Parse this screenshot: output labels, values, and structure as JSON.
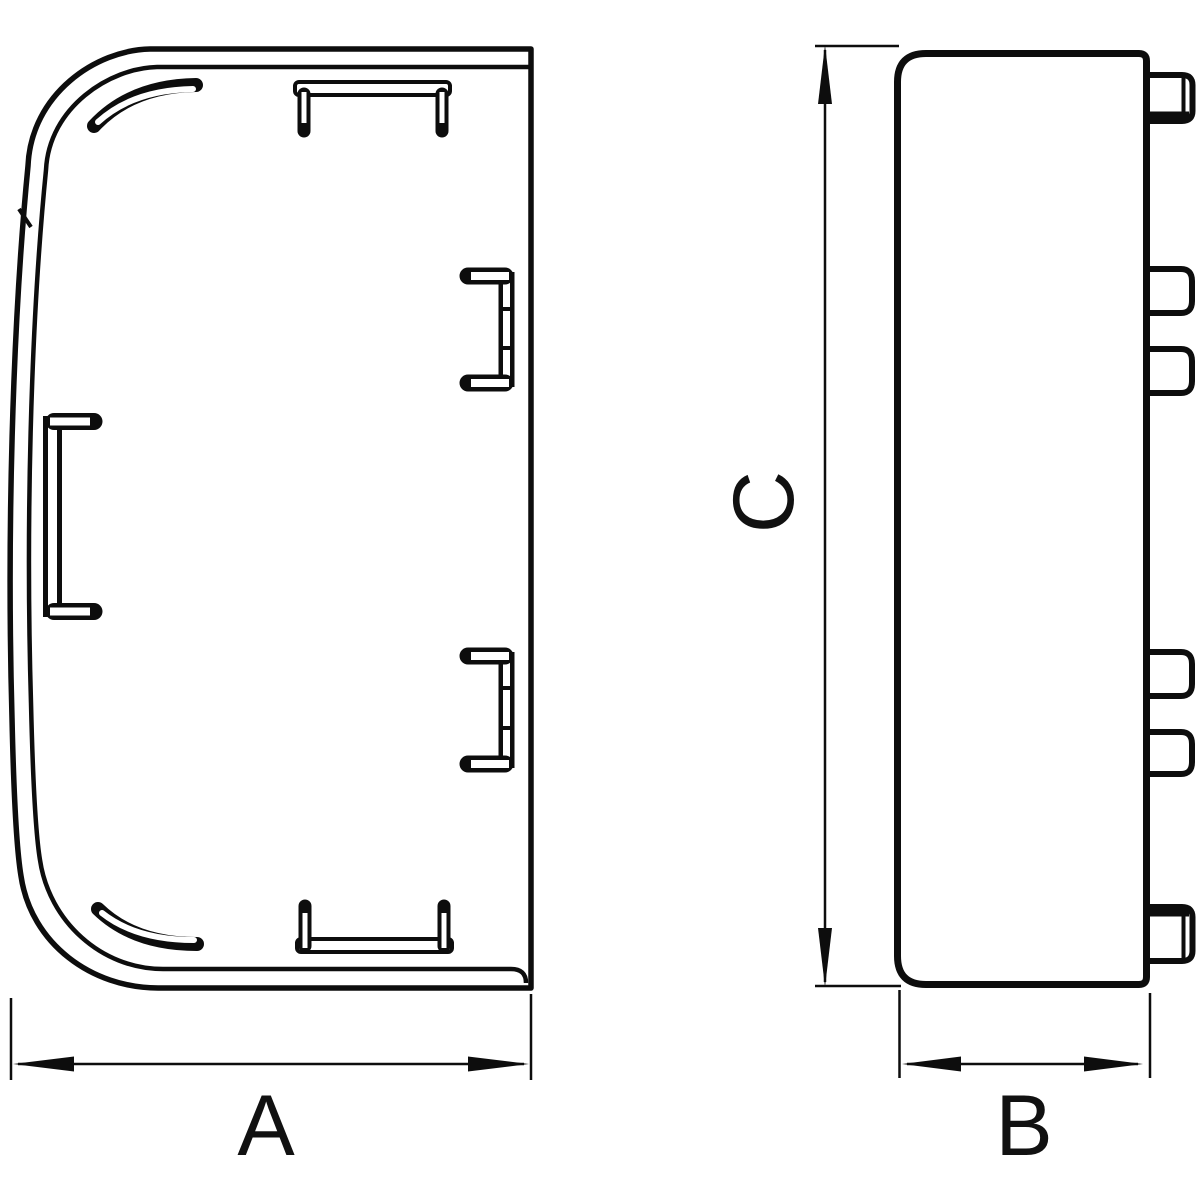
{
  "drawing": {
    "title": "End cap technical drawing, two orthographic views",
    "background_color": "#ffffff",
    "line_color": "#0d0d0d",
    "views": {
      "front_view": {
        "name": "front view with rounded corners, mounting clips and tabs",
        "dimension_label": "A"
      },
      "side_view": {
        "name": "side profile view with six latch tabs",
        "dimension_labels": [
          "C",
          "B"
        ]
      }
    }
  },
  "labels": {
    "a": "A",
    "b": "B",
    "c": "C"
  }
}
